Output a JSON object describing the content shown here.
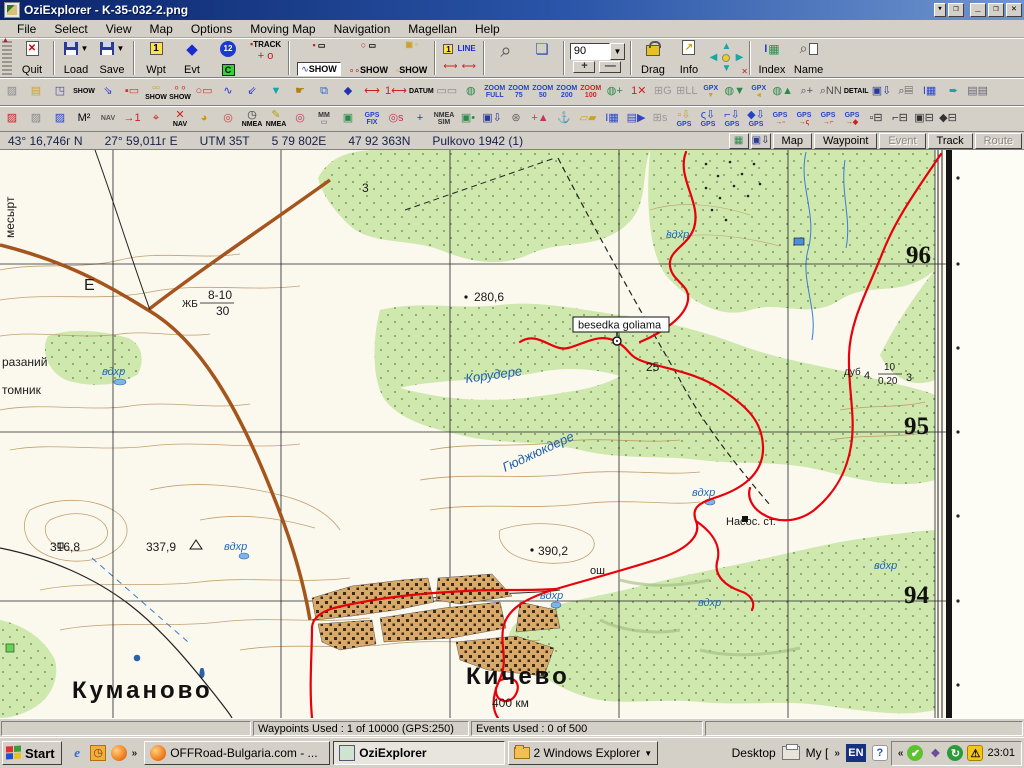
{
  "window": {
    "title": "OziExplorer - K-35-032-2.png"
  },
  "menu": {
    "items": [
      "File",
      "Select",
      "View",
      "Map",
      "Options",
      "Moving Map",
      "Navigation",
      "Magellan",
      "Help"
    ]
  },
  "toolbar1": {
    "quit": "Quit",
    "load": "Load",
    "save": "Save",
    "wpt": "Wpt",
    "evt": "Evt",
    "track": "TRACK",
    "track_sub": "+ o",
    "wp_num": "12",
    "wp_c": "C",
    "show_wpt": "SHOW",
    "show_evt": "SHOW",
    "show_trk": "SHOW",
    "line": "LINE",
    "one": "1",
    "zoom_value": "90",
    "zoom_plus": "+",
    "zoom_minus": "—",
    "drag": "Drag",
    "info": "Info",
    "index": "Index",
    "name": "Name"
  },
  "toolbar2": {
    "icons": [
      {
        "n": "map-check-icon",
        "t": "▨",
        "c": "#8a8a8a"
      },
      {
        "n": "wp-page-icon",
        "t": "▤",
        "c": "#caa227"
      },
      {
        "n": "wp-show-toggle-icon",
        "t": "◳",
        "c": "#4a4aa0"
      },
      {
        "n": "track-show-small-icon",
        "t": "SHOW",
        "c": "#000",
        "w": 1
      },
      {
        "n": "track-arrows-icon",
        "t": "⇘",
        "c": "#3a3acc"
      },
      {
        "n": "wp-list-icon",
        "t": "▪▭",
        "c": "#cc3333"
      },
      {
        "n": "wp-names-show-icon",
        "t": "▫▫",
        "b": "SHOW",
        "c": "#caa227",
        "bc": "#000"
      },
      {
        "n": "event-names-show-icon",
        "t": "∘∘",
        "b": "SHOW",
        "c": "#cc3333",
        "bc": "#000"
      },
      {
        "n": "event-list-icon",
        "t": "○▭",
        "c": "#cc3333"
      },
      {
        "n": "track-profile-icon",
        "t": "∿",
        "c": "#2233cc"
      },
      {
        "n": "track-reduce-icon",
        "t": "⇙",
        "c": "#2233cc"
      },
      {
        "n": "filter-icon",
        "t": "▼",
        "c": "#18a5a5"
      },
      {
        "n": "hand-edit-icon",
        "t": "☛",
        "c": "#b08010"
      },
      {
        "n": "wp-blocks-icon",
        "t": "⧉",
        "c": "#3366cc"
      },
      {
        "n": "event-page-icon",
        "t": "◆",
        "c": "#2233aa"
      },
      {
        "n": "ruler-red-icon",
        "t": "⟷",
        "c": "#cc2222"
      },
      {
        "n": "ruler-wp-icon",
        "t": "1⟷",
        "c": "#cc2222"
      },
      {
        "n": "datum-icon",
        "t": "DATUM",
        "c": "#000",
        "w": 1
      },
      {
        "n": "blank-strip-icon",
        "t": "▭▭",
        "c": "#888"
      },
      {
        "n": "map-import-icon",
        "t": "◍",
        "c": "#2a8a4a"
      },
      {
        "n": "zoom-full-button",
        "t": "ZOOM",
        "b": "FULL",
        "c": "#2244cc",
        "bc": "#2244cc",
        "w": 1
      },
      {
        "n": "zoom-75-button",
        "t": "ZOOM",
        "b": "75",
        "c": "#2244cc",
        "bc": "#2244cc",
        "w": 1
      },
      {
        "n": "zoom-50-button",
        "t": "ZOOM",
        "b": "50",
        "c": "#2244cc",
        "bc": "#2244cc",
        "w": 1
      },
      {
        "n": "zoom-200-button",
        "t": "ZOOM",
        "b": "200",
        "c": "#2244cc",
        "bc": "#2244cc",
        "w": 1
      },
      {
        "n": "zoom-100-button",
        "t": "ZOOM",
        "b": "100",
        "c": "#cc2222",
        "bc": "#cc2222",
        "w": 1
      },
      {
        "n": "map-add-icon",
        "t": "◍+",
        "c": "#2a8a4a"
      },
      {
        "n": "map-delete-icon",
        "t": "1✕",
        "c": "#cc2222"
      },
      {
        "n": "grid-g-icon",
        "t": "⊞G",
        "c": "#999"
      },
      {
        "n": "grid-ll-icon",
        "t": "⊞LL",
        "c": "#999"
      },
      {
        "n": "gpx-write-icon",
        "t": "GPX",
        "b": "▼",
        "c": "#2244cc",
        "bc": "#caa227",
        "w": 1
      },
      {
        "n": "gpx-globe-icon",
        "t": "◍▼",
        "c": "#2a8a4a"
      },
      {
        "n": "gpx-read-icon",
        "t": "GPX",
        "b": "◄",
        "c": "#2244cc",
        "bc": "#caa227",
        "w": 1
      },
      {
        "n": "globe-load-icon",
        "t": "◍▲",
        "c": "#2a8a4a"
      },
      {
        "n": "mag-plus-icon",
        "t": "⌕+",
        "c": "#555"
      },
      {
        "n": "mag-nn-icon",
        "t": "⌕NN",
        "c": "#555"
      },
      {
        "n": "detail-icon",
        "t": "DETAIL",
        "c": "#000",
        "w": 1
      },
      {
        "n": "floppy-down-icon",
        "t": "▣⇩",
        "c": "#2a3a9a"
      },
      {
        "n": "page-find-icon",
        "t": "⌕▤",
        "c": "#555"
      },
      {
        "n": "index-small-icon",
        "t": "I▦",
        "c": "#2244cc"
      },
      {
        "n": "next-map-icon",
        "t": "➨",
        "c": "#18a5a5"
      },
      {
        "n": "pages-icon",
        "t": "▤▤",
        "c": "#667"
      }
    ]
  },
  "toolbar3": {
    "icons": [
      {
        "n": "image-red-icon",
        "t": "▨",
        "c": "#cc2222"
      },
      {
        "n": "image-gray-icon",
        "t": "▨",
        "c": "#888"
      },
      {
        "n": "image-blue-icon",
        "t": "▨",
        "c": "#2244cc"
      },
      {
        "n": "m2-icon",
        "t": "M²",
        "c": "#000"
      },
      {
        "n": "nav-strip-icon",
        "t": "NAV",
        "c": "#555",
        "w": 1
      },
      {
        "n": "wp-arrow-icon",
        "t": "→1",
        "c": "#cc2222"
      },
      {
        "n": "track-point-icon",
        "t": "⌖",
        "c": "#cc2222"
      },
      {
        "n": "nav-cancel-icon",
        "t": "✕",
        "b": "NAV",
        "c": "#cc2222",
        "bc": "#000"
      },
      {
        "n": "pie-icon",
        "t": "◕",
        "c": "#cc9900"
      },
      {
        "n": "lifering-icon",
        "t": "◎",
        "c": "#cc4444"
      },
      {
        "n": "nmea-clock-icon",
        "t": "◷",
        "b": "NMEA",
        "c": "#333",
        "bc": "#000"
      },
      {
        "n": "nmea-pencil-icon",
        "t": "✎",
        "b": "NMEA",
        "c": "#b8a000",
        "bc": "#000"
      },
      {
        "n": "target-icon",
        "t": "◎",
        "c": "#cc3355"
      },
      {
        "n": "mm-ruler-icon",
        "t": "MM",
        "b": "▭",
        "c": "#333",
        "bc": "#888",
        "w": 1
      },
      {
        "n": "monitor-icon",
        "t": "▣",
        "c": "#2a8a4a"
      },
      {
        "n": "gps-fix-icon",
        "t": "GPS",
        "b": "FIX",
        "c": "#2244cc",
        "bc": "#2244cc",
        "w": 1
      },
      {
        "n": "target-s-icon",
        "t": "◎s",
        "c": "#cc3355"
      },
      {
        "n": "pan-icon",
        "t": "+",
        "c": "#2233cc"
      },
      {
        "n": "nmea-sim-icon",
        "t": "NMEA",
        "b": "SIM",
        "c": "#333",
        "bc": "#333",
        "w": 1
      },
      {
        "n": "monitor-rec-icon",
        "t": "▣•",
        "c": "#2a8a4a"
      },
      {
        "n": "save-track-icon",
        "t": "▣⇩",
        "c": "#2a3a9a"
      },
      {
        "n": "grid-config-icon",
        "t": "⊛",
        "c": "#666"
      },
      {
        "n": "plus-flag-icon",
        "t": "+▲",
        "c": "#cc3355"
      },
      {
        "n": "anchor-icon",
        "t": "⚓",
        "c": "#223"
      },
      {
        "n": "pages-yellow-icon",
        "t": "▱▰",
        "c": "#caa227"
      },
      {
        "n": "index-image-icon",
        "t": "I▦",
        "c": "#2244cc"
      },
      {
        "n": "page-arrow-icon",
        "t": "▤▶",
        "c": "#3344cc"
      },
      {
        "n": "grid-s-icon",
        "t": "⊞s",
        "c": "#999"
      },
      {
        "n": "wp-to-gps-icon",
        "t": "▫⇩",
        "b": "GPS",
        "c": "#caa227",
        "bc": "#2244cc"
      },
      {
        "n": "track-to-gps-icon",
        "t": "ς⇩",
        "b": "GPS",
        "c": "#2244cc",
        "bc": "#2244cc"
      },
      {
        "n": "route-to-gps-icon",
        "t": "⌐⇩",
        "b": "GPS",
        "c": "#2244cc",
        "bc": "#2244cc"
      },
      {
        "n": "event-to-gps-icon",
        "t": "◆⇩",
        "b": "GPS",
        "c": "#2244cc",
        "bc": "#2244cc"
      },
      {
        "n": "gps-to-wp-icon",
        "t": "GPS",
        "b": "→▫",
        "c": "#2244cc",
        "bc": "#cc2222",
        "w": 1
      },
      {
        "n": "gps-to-track-icon",
        "t": "GPS",
        "b": "→ς",
        "c": "#2244cc",
        "bc": "#cc2222",
        "w": 1
      },
      {
        "n": "gps-to-route-icon",
        "t": "GPS",
        "b": "→⌐",
        "c": "#2244cc",
        "bc": "#cc2222",
        "w": 1
      },
      {
        "n": "gps-to-event-icon",
        "t": "GPS",
        "b": "→◆",
        "c": "#2244cc",
        "bc": "#cc2222",
        "w": 1
      },
      {
        "n": "print-wp-icon",
        "t": "▫⊟",
        "c": "#333"
      },
      {
        "n": "print-track-icon",
        "t": "⌐⊟",
        "c": "#333"
      },
      {
        "n": "print-map-icon",
        "t": "▣⊟",
        "c": "#333"
      },
      {
        "n": "print-event-icon",
        "t": "◆⊟",
        "c": "#333"
      }
    ]
  },
  "coordbar": {
    "lat": "43° 16,746г N",
    "lon": "27° 59,011г E",
    "utm_zone": "UTM  35T",
    "easting": "5 79 802E",
    "northing": "47 92 363N",
    "datum": "Pulkovo 1942 (1)",
    "buttons": {
      "map": "Map",
      "waypoint": "Waypoint",
      "event": "Event",
      "track": "Track",
      "route": "Route"
    }
  },
  "map": {
    "waypoint_label": "besedka goliama",
    "labels": [
      {
        "t": "месырт",
        "x": 14,
        "y": 88,
        "s": 12,
        "rot": -90,
        "cls": "blk"
      },
      {
        "t": "Е",
        "x": 84,
        "y": 140,
        "s": 16,
        "cls": "blk"
      },
      {
        "t": "разаний",
        "x": 2,
        "y": 216,
        "s": 12,
        "cls": "blk"
      },
      {
        "t": "томник",
        "x": 2,
        "y": 244,
        "s": 12,
        "cls": "blk"
      },
      {
        "t": "3",
        "x": 362,
        "y": 42,
        "s": 12,
        "cls": "blk"
      },
      {
        "t": "вдхр",
        "x": 666,
        "y": 88,
        "s": 11,
        "cls": "wtr"
      },
      {
        "t": "280,6",
        "x": 474,
        "y": 151,
        "s": 12,
        "cls": "blk"
      },
      {
        "t": "ЖБ",
        "x": 182,
        "y": 157,
        "s": 10,
        "cls": "blk"
      },
      {
        "t": "8-10",
        "x": 208,
        "y": 149,
        "s": 12,
        "cls": "blk"
      },
      {
        "t": "30",
        "x": 216,
        "y": 165,
        "s": 12,
        "cls": "blk"
      },
      {
        "t": "вдхр",
        "x": 102,
        "y": 225,
        "s": 11,
        "cls": "wtr"
      },
      {
        "t": "Корудере",
        "x": 466,
        "y": 233,
        "s": 13,
        "rot": -8,
        "cls": "wtr-i"
      },
      {
        "t": "25",
        "x": 646,
        "y": 221,
        "s": 12,
        "cls": "blk"
      },
      {
        "t": "дуб",
        "x": 844,
        "y": 225,
        "s": 10,
        "cls": "blk"
      },
      {
        "t": "4",
        "x": 864,
        "y": 229,
        "s": 11,
        "cls": "blk"
      },
      {
        "t": "10",
        "x": 884,
        "y": 220,
        "s": 10,
        "cls": "blk"
      },
      {
        "t": "0,20",
        "x": 878,
        "y": 234,
        "s": 10,
        "cls": "blk"
      },
      {
        "t": "3",
        "x": 906,
        "y": 231,
        "s": 11,
        "cls": "blk"
      },
      {
        "t": "96",
        "x": 906,
        "y": 113,
        "s": 25,
        "cls": "grid"
      },
      {
        "t": "95",
        "x": 904,
        "y": 284,
        "s": 25,
        "cls": "grid"
      },
      {
        "t": "94",
        "x": 904,
        "y": 453,
        "s": 25,
        "cls": "grid"
      },
      {
        "t": "Гюджюкдере",
        "x": 505,
        "y": 322,
        "s": 13,
        "rot": -25,
        "cls": "wtr-i"
      },
      {
        "t": "вдхр",
        "x": 224,
        "y": 400,
        "s": 11,
        "cls": "wtr"
      },
      {
        "t": "316,8",
        "x": 50,
        "y": 401,
        "s": 12,
        "cls": "blk"
      },
      {
        "t": "337,9",
        "x": 146,
        "y": 401,
        "s": 12,
        "cls": "blk"
      },
      {
        "t": "390,2",
        "x": 538,
        "y": 405,
        "s": 12,
        "cls": "blk"
      },
      {
        "t": "вдхр",
        "x": 692,
        "y": 346,
        "s": 11,
        "cls": "wtr"
      },
      {
        "t": "Насос. ст.",
        "x": 726,
        "y": 375,
        "s": 11,
        "cls": "blk"
      },
      {
        "t": "вдхр",
        "x": 540,
        "y": 449,
        "s": 11,
        "cls": "wtr"
      },
      {
        "t": "вдхр",
        "x": 698,
        "y": 456,
        "s": 11,
        "cls": "wtr"
      },
      {
        "t": "вдхр",
        "x": 874,
        "y": 419,
        "s": 11,
        "cls": "wtr"
      },
      {
        "t": "ош",
        "x": 590,
        "y": 424,
        "s": 11,
        "cls": "blk"
      },
      {
        "t": "Куманово",
        "x": 72,
        "y": 548,
        "s": 24,
        "cls": "town"
      },
      {
        "t": "Кичево",
        "x": 466,
        "y": 534,
        "s": 24,
        "cls": "town"
      },
      {
        "t": "400 км",
        "x": 492,
        "y": 557,
        "s": 12,
        "cls": "blk"
      }
    ]
  },
  "statusbar": {
    "waypoints": "Waypoints Used : 1 of 10000  (GPS:250)",
    "events": "Events Used : 0 of 500"
  },
  "taskbar": {
    "start": "Start",
    "tasks": [
      {
        "label": "OFFRoad-Bulgaria.com - ..."
      },
      {
        "label": "OziExplorer"
      },
      {
        "label": "2 Windows Explorer"
      }
    ],
    "desktop_label": "Desktop",
    "my_label": "My [",
    "lang": "EN",
    "clock": "23:01"
  }
}
